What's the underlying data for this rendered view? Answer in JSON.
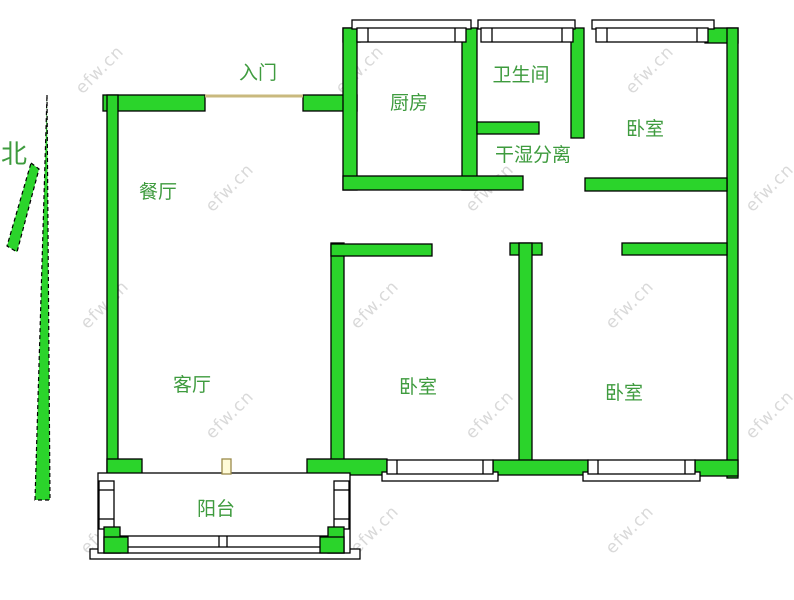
{
  "compass": {
    "label": "北"
  },
  "entrance": {
    "label": "入门"
  },
  "rooms": {
    "dining": {
      "label": "餐厅"
    },
    "living": {
      "label": "客厅"
    },
    "kitchen": {
      "label": "厨房"
    },
    "bathroom": {
      "label": "卫生间"
    },
    "dry_wet": {
      "label": "干湿分离"
    },
    "bedroom_top_right": {
      "label": "卧室"
    },
    "bedroom_bottom_middle": {
      "label": "卧室"
    },
    "bedroom_bottom_right": {
      "label": "卧室"
    },
    "balcony": {
      "label": "阳台"
    }
  },
  "watermark": {
    "text": "efw.cn"
  },
  "colors": {
    "wall_fill": "#2BD42B",
    "wall_stroke": "#000000",
    "label_text": "#3E9B3E",
    "entry_door_line": "#C9B97E",
    "door_symbol_fill": "#FFFBD8",
    "watermark_text": "#D9D9D9",
    "background": "#FFFFFF"
  }
}
